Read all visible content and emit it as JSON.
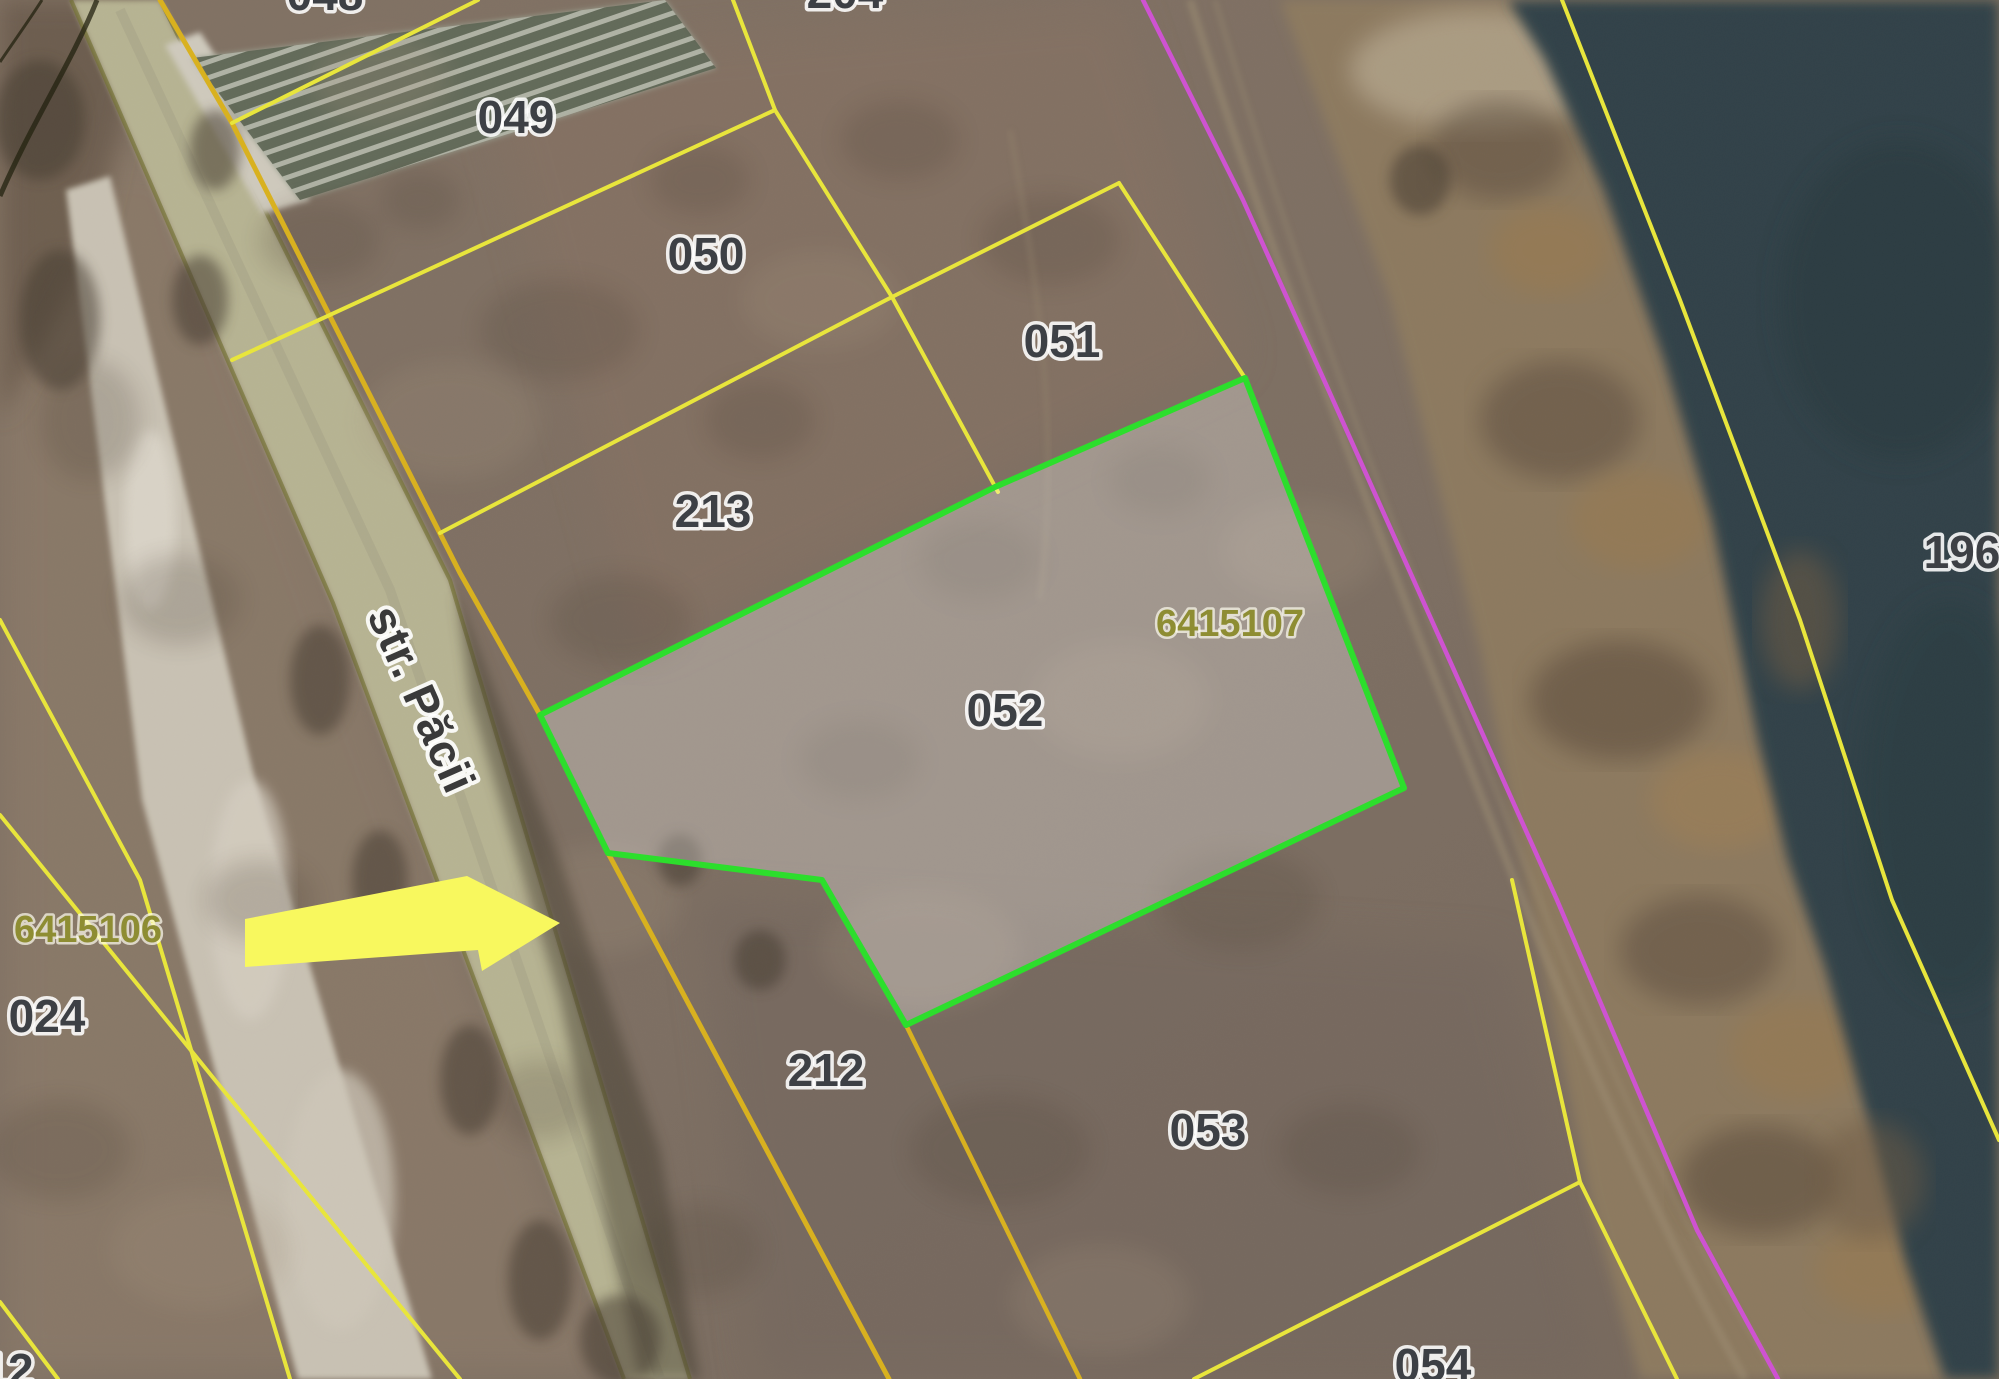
{
  "map": {
    "street": {
      "label": "str. Păcii"
    },
    "parcels": {
      "p048": "048",
      "p204": "204",
      "p049": "049",
      "p050": "050",
      "p051": "051",
      "p213": "213",
      "p052": "052",
      "p212": "212",
      "p053": "053",
      "p054": "054",
      "p024": "024",
      "p196": "196",
      "p12": "12"
    },
    "cadastral": {
      "c6415107": "6415107",
      "c6415106": "6415106"
    },
    "highlight": {
      "parcel": "052",
      "cadastral_number": "6415107",
      "outline_color": "#2bdf2b",
      "fill_color": "#ffffff45"
    },
    "colors": {
      "parcel_line": "#e9e63b",
      "road_boundary_line": "#d9b11e",
      "utility_line": "#cf52d2",
      "arrow": "#f8f85e",
      "water": "#314349",
      "road_surface": "#b7b493",
      "parcel_label": "#3d4045",
      "cadastral_label": "#8e8d33"
    }
  }
}
